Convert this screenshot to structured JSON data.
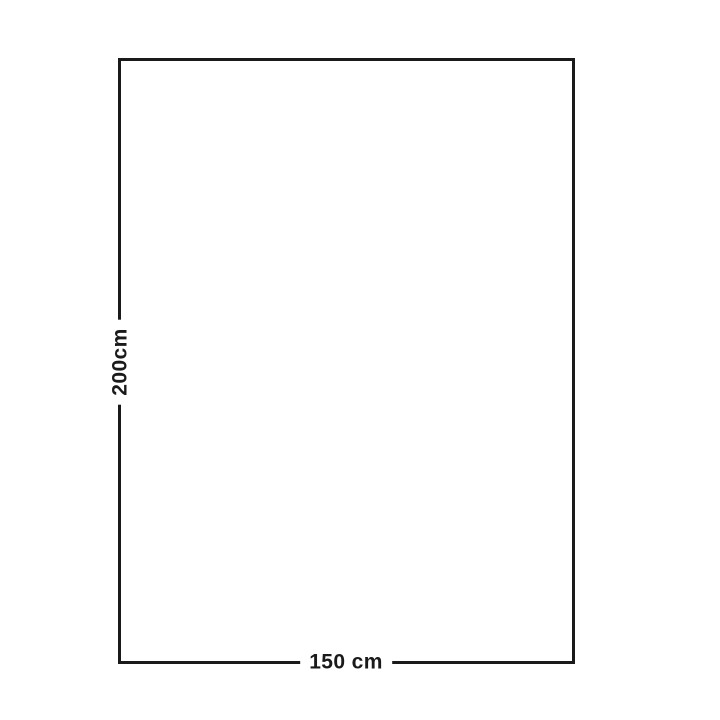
{
  "diagram": {
    "type": "rectangle-dimension-diagram",
    "height_label": "200cm",
    "width_label": "150 cm",
    "height_value_cm": 200,
    "width_value_cm": 150,
    "line_color": "#1a1a1a",
    "text_color": "#1a1a1a",
    "background_color": "#ffffff"
  }
}
